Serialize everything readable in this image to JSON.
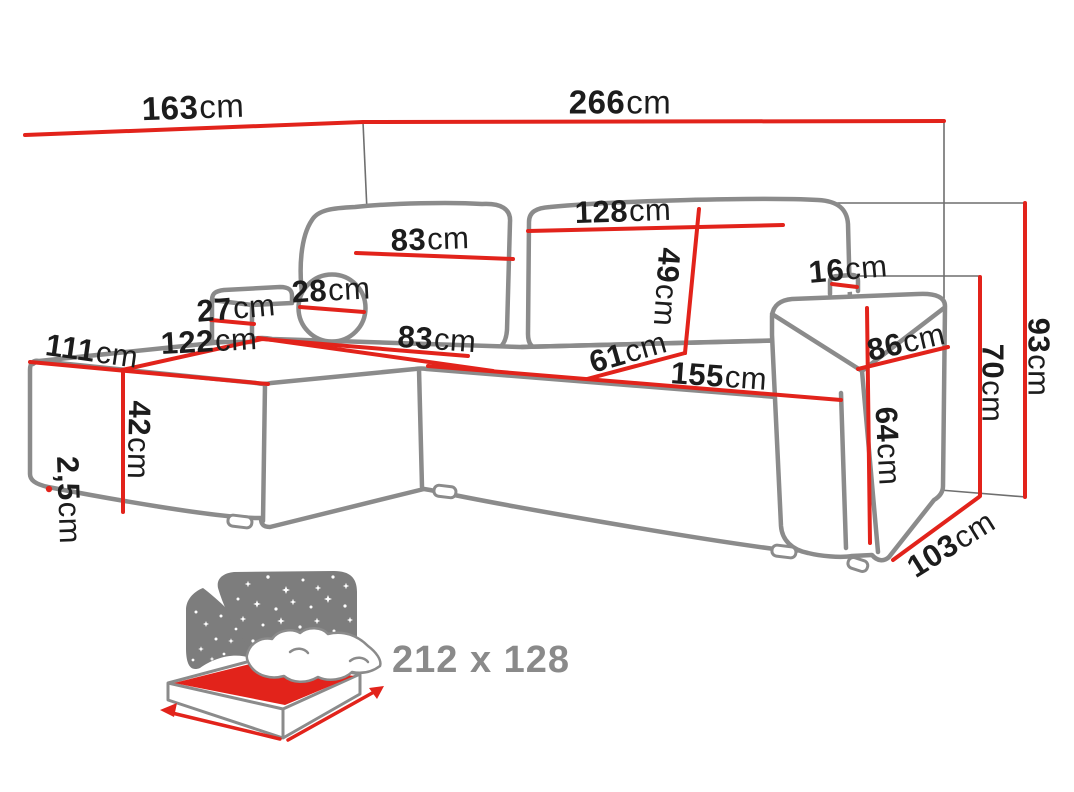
{
  "diagram": {
    "title": "corner-sofa-dimension-diagram",
    "unit_default": "cm",
    "colors": {
      "dimension_red": "#e2231b",
      "outline_gray": "#8b8b8b",
      "thin_line_gray": "#6f6f6f",
      "icon_gray": "#7d7d7d",
      "label_black": "#1c1c1c",
      "size_text_gray": "#8a8a8a"
    },
    "dimensions": {
      "width_left_section": {
        "value": "163",
        "unit": "cm"
      },
      "width_total": {
        "value": "266",
        "unit": "cm"
      },
      "backrest_right_width": {
        "value": "128",
        "unit": "cm"
      },
      "backrest_left_width": {
        "value": "83",
        "unit": "cm"
      },
      "backrest_height": {
        "value": "49",
        "unit": "cm"
      },
      "armrest_top_width": {
        "value": "16",
        "unit": "cm"
      },
      "headrest_box_width": {
        "value": "27",
        "unit": "cm"
      },
      "round_pillow_diameter": {
        "value": "28",
        "unit": "cm"
      },
      "chaise_diagonal": {
        "value": "122",
        "unit": "cm"
      },
      "chaise_width": {
        "value": "111",
        "unit": "cm"
      },
      "seat_depth": {
        "value": "83",
        "unit": "cm"
      },
      "corner_seat_width": {
        "value": "61",
        "unit": "cm"
      },
      "seat_front_width": {
        "value": "155",
        "unit": "cm"
      },
      "armrest_depth": {
        "value": "86",
        "unit": "cm"
      },
      "seat_height": {
        "value": "42",
        "unit": "cm"
      },
      "leg_height": {
        "value": "2,5",
        "unit": "cm"
      },
      "armrest_side_height": {
        "value": "64",
        "unit": "cm"
      },
      "armrest_total_height": {
        "value": "70",
        "unit": "cm"
      },
      "total_height": {
        "value": "93",
        "unit": "cm"
      },
      "total_depth": {
        "value": "103",
        "unit": "cm"
      }
    },
    "sleeping_area": {
      "icon": "sofa-bed-sleeping-function-icon",
      "label": "212 x 128"
    }
  }
}
